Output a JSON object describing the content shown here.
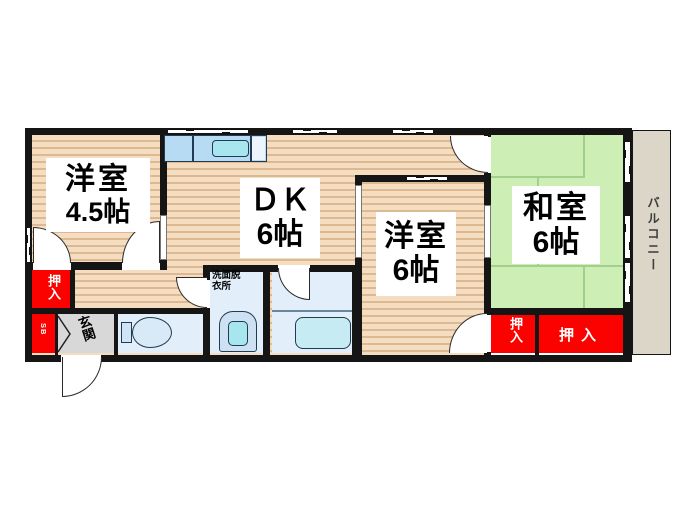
{
  "floor_plan": {
    "rooms": [
      {
        "id": "western45",
        "name": "洋室",
        "size": "4.5帖"
      },
      {
        "id": "dk",
        "name": "ＤＫ",
        "size": "6帖"
      },
      {
        "id": "western6",
        "name": "洋室",
        "size": "6帖"
      },
      {
        "id": "japanese6",
        "name": "和室",
        "size": "6帖"
      }
    ],
    "labels": {
      "balcony": "バルコニー",
      "entrance": "玄関",
      "washroom_line1": "洗面脱",
      "washroom_line2": "衣所",
      "closet_left": "押入",
      "closet_small": "押入",
      "closet_wide": "押入",
      "shoe_box": "SB"
    },
    "colors": {
      "wall_black": "#151515",
      "wood_floor": "#f4ddc0",
      "wood_stripe": "#dcb991",
      "tatami": "#cdeeb5",
      "tatami_line": "#a3cf8c",
      "closet_red": "#fb0200",
      "entrance_gray": "#d8d8d8",
      "wet_room_blue": "#e2eefa",
      "fixture_blue": "#b7dbf3",
      "sink_cyan": "#a8e6ef",
      "balcony_beige": "#dcd6c9"
    }
  }
}
